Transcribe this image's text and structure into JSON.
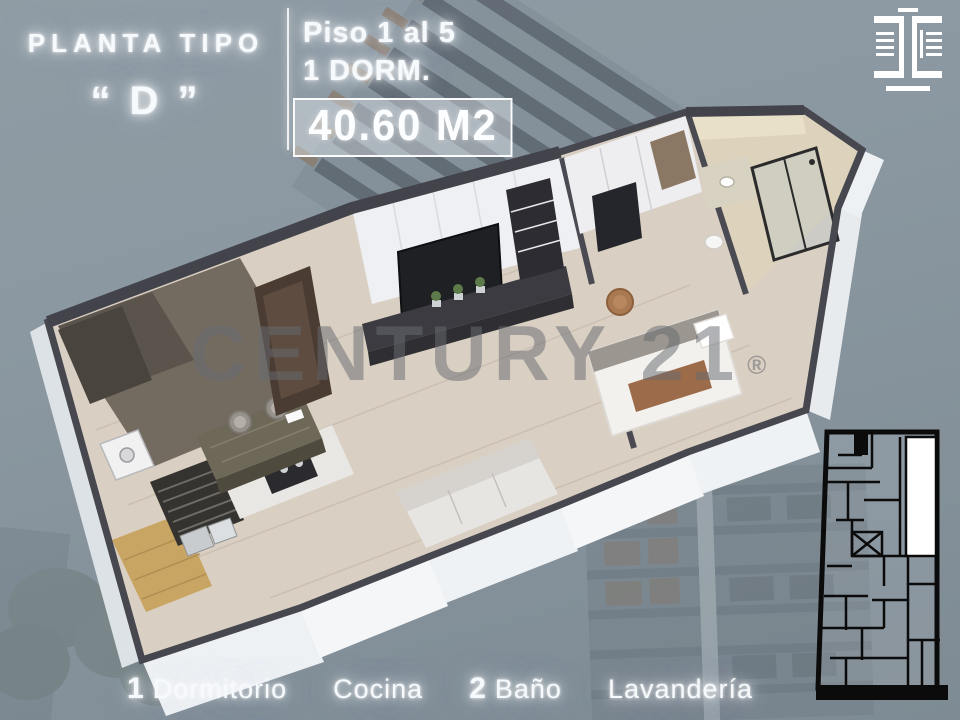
{
  "header": {
    "title": "PLANTA TIPO",
    "unit_letter": "“ D ”",
    "floors": "Piso 1 al 5",
    "bedrooms": "1 DORM.",
    "area": "40.60 M2"
  },
  "watermark": {
    "text": "CENTURY 21",
    "reg": "®"
  },
  "footer": {
    "items": [
      {
        "num": "1",
        "label": "Dormitorio"
      },
      {
        "num": "",
        "label": "Cocina"
      },
      {
        "num": "2",
        "label": "Baño"
      },
      {
        "num": "",
        "label": "Lavandería"
      }
    ]
  },
  "icons": {
    "brand_logo": "mirrored-brackets-building-logo",
    "key_plan": "building-footprint-key-plan",
    "render": "isometric-3d-floorplan"
  },
  "colors": {
    "background": "#8b98a1",
    "text_glow_white": "#f7fafc",
    "wall_top_dark": "#47474f",
    "wall_white": "#f3f5f6",
    "floor_wood": "#d9cfc2",
    "terrace_wood": "#c9a564",
    "counter_marble": "#6e6859",
    "watermark_gray": "#686b72",
    "keyplan_black": "#0b0b0b",
    "keyplan_highlight": "#ffffff"
  }
}
